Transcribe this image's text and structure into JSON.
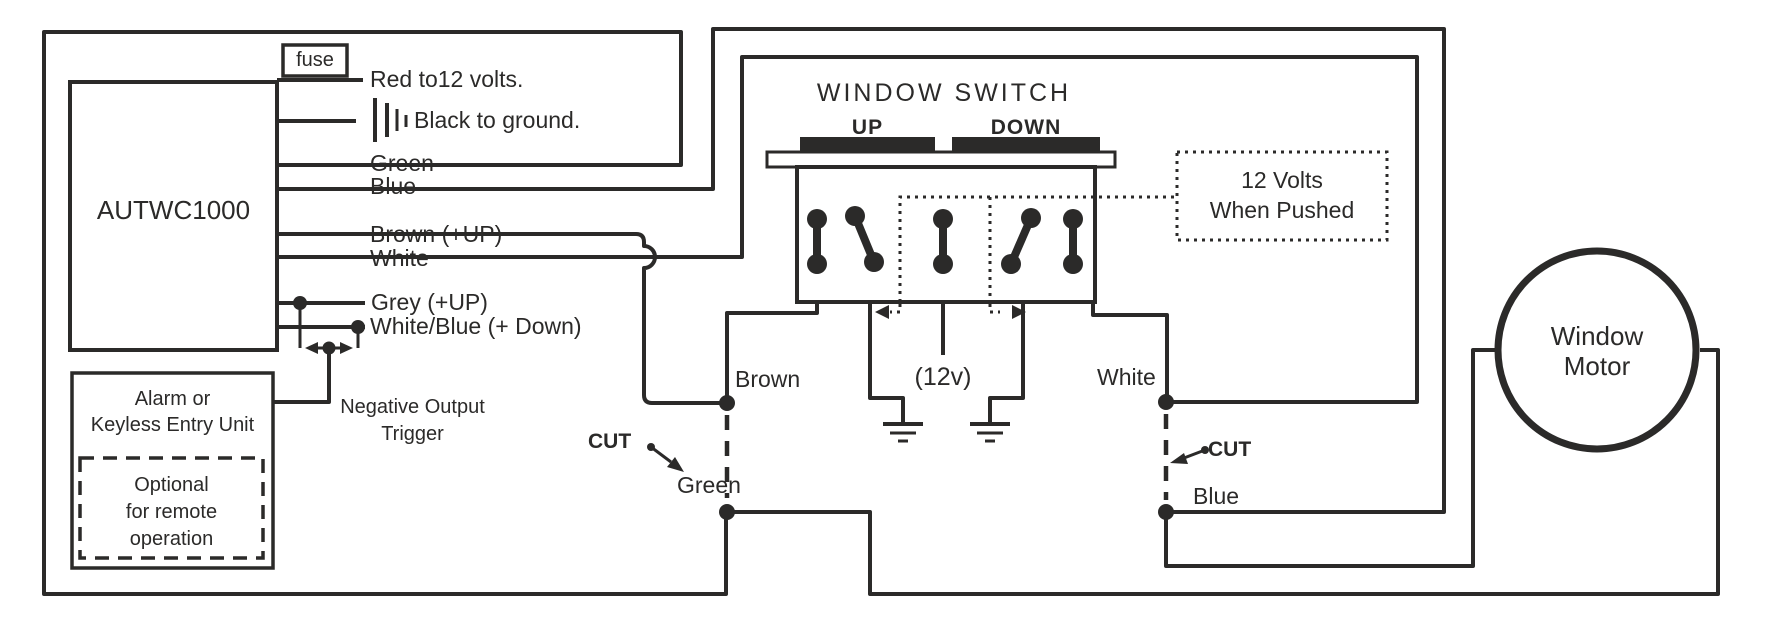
{
  "module": {
    "name": "AUTWC1000"
  },
  "fuse_label": "fuse",
  "module_wires": {
    "red": "Red to12 volts.",
    "black": "Black to ground.",
    "green": "Green",
    "blue": "Blue",
    "brown": "Brown (+UP)",
    "white": "White",
    "grey": "Grey (+UP)",
    "white_blue": "White/Blue (+ Down)"
  },
  "alarm_unit": {
    "title_line1": "Alarm or",
    "title_line2": "Keyless Entry Unit",
    "note_line1": "Optional",
    "note_line2": "for remote",
    "note_line3": "operation"
  },
  "trigger": {
    "line1": "Negative Output",
    "line2": "Trigger"
  },
  "window_switch": {
    "title": "WINDOW SWITCH",
    "up_label": "UP",
    "down_label": "DOWN",
    "pushed_note_line1": "12 Volts",
    "pushed_note_line2": "When Pushed",
    "supply_label": "(12v)"
  },
  "cut_instructions": {
    "left": "CUT",
    "right": "CUT"
  },
  "wire_junctions": {
    "brown": "Brown",
    "white": "White",
    "green": "Green",
    "blue": "Blue"
  },
  "motor": {
    "line1": "Window",
    "line2": "Motor"
  },
  "colors": {
    "line": "#2b2a29",
    "text": "#2b2a29",
    "background": "#ffffff"
  }
}
